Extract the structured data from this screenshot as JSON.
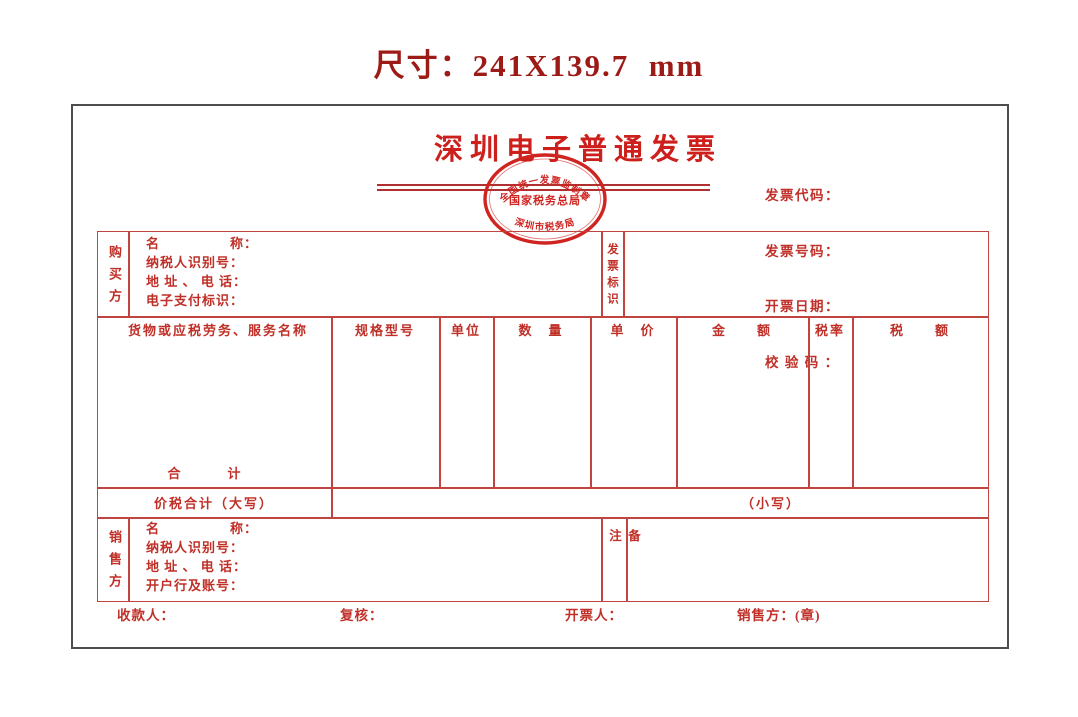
{
  "page": {
    "size_label": "尺寸：241X139.7  mm"
  },
  "colors": {
    "accent_red": "#c03028",
    "grid_red": "#c04540",
    "heading_maroon": "#9c1b17",
    "outer_border": "#4d4d4d"
  },
  "invoice": {
    "title": "深圳电子普通发票",
    "stamp": {
      "top_text": "全国统一发票监制章",
      "middle_text": "国家税务总局",
      "bottom_text": "深圳市税务局"
    },
    "meta": {
      "code_label": "发票代码：",
      "number_label": "发票号码：",
      "date_label": "开票日期：",
      "check_label": "校 验 码 ："
    },
    "buyer": {
      "side_label": "购买方",
      "fields": [
        "名　　　　　称：",
        "纳税人识别号：",
        "地 址 、 电 话：",
        "电子支付标识："
      ]
    },
    "invoice_mark_label": "发票标识",
    "items_table": {
      "headers": [
        "货物或应税劳务、服务名称",
        "规格型号",
        "单位",
        "数　量",
        "单　价",
        "金　　额",
        "税率",
        "税　　额"
      ],
      "total_label": "合　　　计"
    },
    "total_row": {
      "words_label": "价税合计（大写）",
      "figures_label": "（小写）"
    },
    "seller": {
      "side_label": "销售方",
      "fields": [
        "名　　　　　称：",
        "纳税人识别号：",
        "地 址 、 电 话：",
        "开户行及账号："
      ]
    },
    "remark_label": "备注",
    "footer": {
      "payee_label": "收款人：",
      "reviewer_label": "复核：",
      "drawer_label": "开票人：",
      "seller_seal_label": "销售方：(章)"
    }
  }
}
